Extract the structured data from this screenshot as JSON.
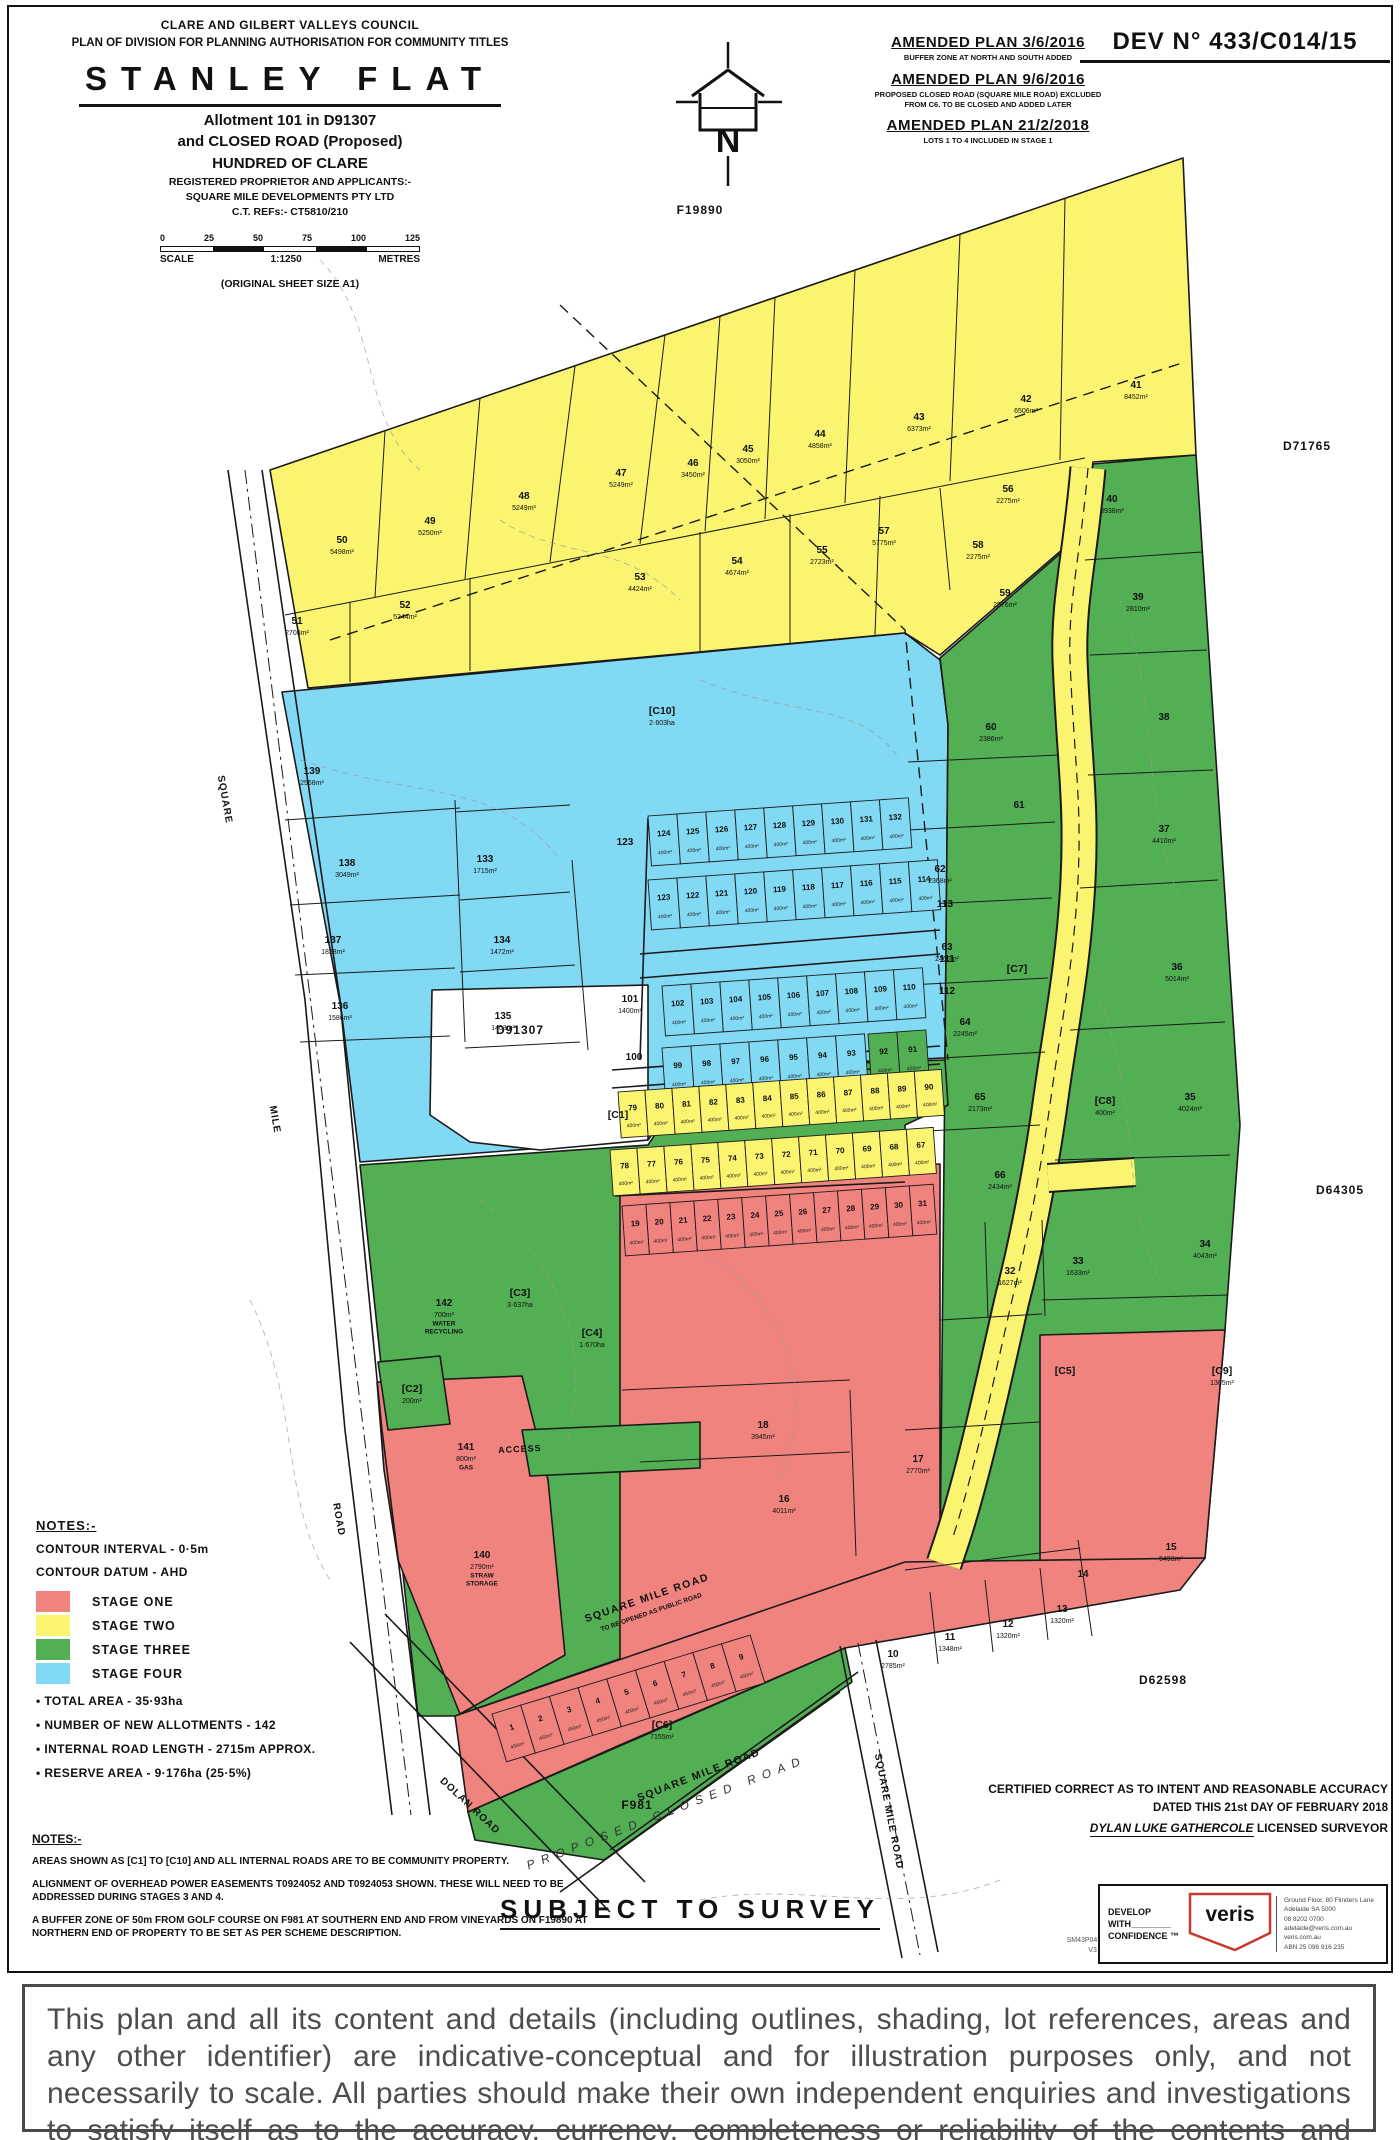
{
  "title_block": {
    "council": "CLARE AND GILBERT VALLEYS COUNCIL",
    "plan_type": "PLAN OF DIVISION FOR PLANNING AUTHORISATION FOR COMMUNITY TITLES",
    "title": "STANLEY FLAT",
    "allotment": "Allotment 101 in D91307",
    "closed_road": "and CLOSED ROAD (Proposed)",
    "hundred": "HUNDRED OF CLARE",
    "proprietor_label": "REGISTERED PROPRIETOR AND APPLICANTS:-",
    "proprietor": "SQUARE MILE DEVELOPMENTS PTY LTD",
    "ct_ref": "C.T. REFs:- CT5810/210",
    "scale_numbers": [
      "0",
      "25",
      "50",
      "75",
      "100",
      "125"
    ],
    "scale_label": "SCALE",
    "scale_ratio": "1:1250",
    "scale_units": "METRES",
    "sheet_size": "(ORIGINAL SHEET SIZE A1)"
  },
  "dev_no": "DEV N° 433/C014/15",
  "amendments": [
    {
      "title": "AMENDED PLAN 3/6/2016",
      "note": "BUFFER ZONE AT NORTH AND SOUTH ADDED"
    },
    {
      "title": "AMENDED PLAN 9/6/2016",
      "note": "PROPOSED CLOSED ROAD (SQUARE MILE ROAD) EXCLUDED",
      "note2": "FROM C6. TO BE CLOSED AND ADDED LATER"
    },
    {
      "title": "AMENDED PLAN 21/2/2018",
      "note": "LOTS 1 TO 4 INCLUDED IN STAGE 1"
    }
  ],
  "legend": {
    "head": "NOTES:-",
    "contour_interval": "CONTOUR INTERVAL - 0·5m",
    "contour_datum": "CONTOUR DATUM - AHD",
    "stages": [
      {
        "label": "STAGE ONE",
        "color": "#F1837F"
      },
      {
        "label": "STAGE TWO",
        "color": "#FAF470"
      },
      {
        "label": "STAGE THREE",
        "color": "#53AF53"
      },
      {
        "label": "STAGE FOUR",
        "color": "#82D9F4"
      }
    ],
    "bullets": [
      "TOTAL AREA - 35·93ha",
      "NUMBER OF NEW ALLOTMENTS - 142",
      "INTERNAL ROAD LENGTH - 2715m APPROX.",
      "RESERVE AREA - 9·176ha (25·5%)"
    ]
  },
  "notes2": {
    "head": "NOTES:-",
    "p1": "AREAS SHOWN AS [C1] TO [C10] AND ALL INTERNAL ROADS ARE TO BE COMMUNITY PROPERTY.",
    "p2": "ALIGNMENT OF OVERHEAD POWER EASEMENTS T0924052 AND T0924053 SHOWN. THESE WILL NEED TO BE ADDRESSED DURING STAGES 3 AND 4.",
    "p3": "A BUFFER ZONE OF 50m FROM GOLF COURSE ON F981 AT SOUTHERN END AND FROM VINEYARDS ON F19890 AT NORTHERN END OF PROPERTY TO BE SET AS PER SCHEME DESCRIPTION."
  },
  "certification": {
    "l1": "CERTIFIED CORRECT AS TO INTENT AND REASONABLE ACCURACY",
    "l2": "DATED THIS 21st DAY OF FEBRUARY 2018",
    "surveyor": "DYLAN LUKE GATHERCOLE",
    "surveyor_title": " LICENSED SURVEYOR"
  },
  "subject_to_survey": "SUBJECT TO SURVEY",
  "footer": {
    "file_ref_1": "SM43P04-v15.DWG",
    "file_ref_2": "V3  21/2/2018",
    "develop_1": "DEVELOP",
    "develop_2": "WITH________",
    "develop_3": "CONFIDENCE ™",
    "veris": "veris",
    "veris_color": "#C43A2E",
    "address_lines": [
      "Ground Floor, 80 Flinders Lane",
      "Adelaide SA 5000",
      "08 8202 0700",
      "adelaide@veris.com.au",
      "veris.com.au",
      "ABN 25 098 916 235"
    ]
  },
  "disclaimer": "This plan and all its content and details (including outlines, shading, lot references, areas and any other identifier) are indicative-conceptual and for illustration purposes only, and not necessarily to scale. All parties should make their own independent enquiries and investigations to satisfy itself as to the accuracy, currency, completeness or reliability of the contents and details contained in this plan",
  "map": {
    "colors": {
      "stage_one": "#F1837F",
      "stage_two": "#FAF470",
      "stage_three": "#53AF53",
      "stage_four": "#82D9F4",
      "line": "#1a1a1a"
    },
    "north_label": "N",
    "adjacent_labels": [
      {
        "t": "F19890",
        "x": 700,
        "y": 214
      },
      {
        "t": "D71765",
        "x": 1307,
        "y": 450
      },
      {
        "t": "D64305",
        "x": 1340,
        "y": 1194
      },
      {
        "t": "D62598",
        "x": 1163,
        "y": 1684
      },
      {
        "t": "D91307",
        "x": 520,
        "y": 1034
      },
      {
        "t": "F981",
        "x": 637,
        "y": 1809
      }
    ],
    "road_labels": [
      {
        "t": "SQUARE",
        "x": 222,
        "y": 800,
        "r": 80,
        "s": "rl"
      },
      {
        "t": "MILE",
        "x": 272,
        "y": 1120,
        "r": 80,
        "s": "rl"
      },
      {
        "t": "ROAD",
        "x": 336,
        "y": 1520,
        "r": 80,
        "s": "rl"
      },
      {
        "t": "DOLAN ROAD",
        "x": 468,
        "y": 1808,
        "r": 43,
        "s": "rl"
      },
      {
        "t": "SQUARE MILE ROAD",
        "x": 648,
        "y": 1601,
        "r": -19,
        "s": "rl-bold"
      },
      {
        "t": "TO BE OPENED AS PUBLIC ROAD",
        "x": 652,
        "y": 1614,
        "r": -19,
        "s": "rl-tiny"
      },
      {
        "t": "SQUARE MILE ROAD",
        "x": 700,
        "y": 1778,
        "r": -21,
        "s": "rl-bold"
      },
      {
        "t": "PROPOSED  CLOSED  ROAD",
        "x": 668,
        "y": 1816,
        "r": -21,
        "s": "rl-spread"
      },
      {
        "t": "SQUARE MILE ROAD",
        "x": 886,
        "y": 1812,
        "r": 79,
        "s": "rl"
      },
      {
        "t": "ACCESS",
        "x": 520,
        "y": 1452,
        "r": -3,
        "s": "rl-small"
      }
    ],
    "lots": [
      {
        "n": "41",
        "a": "8452m²",
        "x": 1136,
        "y": 388
      },
      {
        "n": "42",
        "a": "6506m²",
        "x": 1026,
        "y": 402
      },
      {
        "n": "43",
        "a": "6373m²",
        "x": 919,
        "y": 420
      },
      {
        "n": "44",
        "a": "4858m²",
        "x": 820,
        "y": 437
      },
      {
        "n": "45",
        "a": "3050m²",
        "x": 748,
        "y": 452
      },
      {
        "n": "46",
        "a": "3450m²",
        "x": 693,
        "y": 466
      },
      {
        "n": "47",
        "a": "5249m²",
        "x": 621,
        "y": 476
      },
      {
        "n": "48",
        "a": "5249m²",
        "x": 524,
        "y": 499
      },
      {
        "n": "49",
        "a": "5250m²",
        "x": 430,
        "y": 524
      },
      {
        "n": "50",
        "a": "5498m²",
        "x": 342,
        "y": 543
      },
      {
        "n": "51",
        "a": "2708m²",
        "x": 297,
        "y": 624
      },
      {
        "n": "52",
        "a": "5244m²",
        "x": 405,
        "y": 608
      },
      {
        "n": "53",
        "a": "4424m²",
        "x": 640,
        "y": 580
      },
      {
        "n": "54",
        "a": "4674m²",
        "x": 737,
        "y": 564
      },
      {
        "n": "55",
        "a": "2723m²",
        "x": 822,
        "y": 553
      },
      {
        "n": "57",
        "a": "5775m²",
        "x": 884,
        "y": 534
      },
      {
        "n": "56",
        "a": "2275m²",
        "x": 1008,
        "y": 492
      },
      {
        "n": "58",
        "a": "2275m²",
        "x": 978,
        "y": 548
      },
      {
        "n": "59",
        "a": "2576m²",
        "x": 1005,
        "y": 596
      },
      {
        "n": "60",
        "a": "2386m²",
        "x": 991,
        "y": 730
      },
      {
        "n": "61",
        "x": 1019,
        "y": 808
      },
      {
        "n": "62",
        "a": "2368m²",
        "x": 940,
        "y": 872
      },
      {
        "n": "63",
        "a": "2465m²",
        "x": 947,
        "y": 950
      },
      {
        "n": "64",
        "a": "2245m²",
        "x": 965,
        "y": 1025
      },
      {
        "n": "65",
        "a": "2173m²",
        "x": 980,
        "y": 1100
      },
      {
        "n": "66",
        "a": "2434m²",
        "x": 1000,
        "y": 1178
      },
      {
        "n": "40",
        "a": "3938m²",
        "x": 1112,
        "y": 502
      },
      {
        "n": "39",
        "a": "2810m²",
        "x": 1138,
        "y": 600
      },
      {
        "n": "38",
        "x": 1164,
        "y": 720
      },
      {
        "n": "37",
        "a": "4410m²",
        "x": 1164,
        "y": 832
      },
      {
        "n": "36",
        "a": "5014m²",
        "x": 1177,
        "y": 970
      },
      {
        "n": "35",
        "a": "4024m²",
        "x": 1190,
        "y": 1100
      },
      {
        "n": "34",
        "a": "4043m²",
        "x": 1205,
        "y": 1247
      },
      {
        "n": "[C10]",
        "a": "2·603ha",
        "x": 662,
        "y": 714,
        "c": 1
      },
      {
        "n": "139",
        "a": "2568m²",
        "x": 312,
        "y": 774
      },
      {
        "n": "138",
        "a": "3049m²",
        "x": 347,
        "y": 866
      },
      {
        "n": "137",
        "a": "1828m²",
        "x": 333,
        "y": 943
      },
      {
        "n": "136",
        "a": "1586m²",
        "x": 340,
        "y": 1009
      },
      {
        "n": "133",
        "a": "1715m²",
        "x": 485,
        "y": 862
      },
      {
        "n": "134",
        "a": "1472m²",
        "x": 502,
        "y": 943
      },
      {
        "n": "135",
        "a": "1403m²",
        "x": 503,
        "y": 1019
      },
      {
        "n": "123",
        "x": 625,
        "y": 845
      },
      {
        "n": "113",
        "x": 945,
        "y": 907
      },
      {
        "n": "111",
        "x": 947,
        "y": 962
      },
      {
        "n": "112",
        "x": 947,
        "y": 994
      },
      {
        "n": "101",
        "a": "1400m²",
        "x": 630,
        "y": 1002
      },
      {
        "n": "100",
        "x": 634,
        "y": 1060
      },
      {
        "n": "[C1]",
        "x": 618,
        "y": 1118,
        "c": 1
      },
      {
        "n": "32",
        "a": "1627m²",
        "x": 1010,
        "y": 1274
      },
      {
        "n": "33",
        "a": "1633m²",
        "x": 1078,
        "y": 1264
      },
      {
        "n": "[C4]",
        "a": "1·670ha",
        "x": 592,
        "y": 1336,
        "c": 1
      },
      {
        "n": "18",
        "a": "3945m²",
        "x": 763,
        "y": 1428
      },
      {
        "n": "16",
        "a": "4011m²",
        "x": 784,
        "y": 1502
      },
      {
        "n": "17",
        "a": "2770m²",
        "x": 918,
        "y": 1462
      },
      {
        "n": "[C5]",
        "x": 1065,
        "y": 1374,
        "c": 1
      },
      {
        "n": "[C9]",
        "a": "1305m²",
        "x": 1222,
        "y": 1374,
        "c": 1
      },
      {
        "n": "[C7]",
        "x": 1017,
        "y": 972,
        "c": 1
      },
      {
        "n": "[C8]",
        "a": "400m²",
        "x": 1105,
        "y": 1104,
        "c": 1
      },
      {
        "n": "15",
        "a": "5493m²",
        "x": 1171,
        "y": 1550
      },
      {
        "n": "14",
        "x": 1083,
        "y": 1577
      },
      {
        "n": "10",
        "a": "2785m²",
        "x": 893,
        "y": 1657
      },
      {
        "n": "11",
        "a": "1348m²",
        "x": 950,
        "y": 1640
      },
      {
        "n": "12",
        "a": "1320m²",
        "x": 1008,
        "y": 1627
      },
      {
        "n": "13",
        "a": "1320m²",
        "x": 1062,
        "y": 1612
      },
      {
        "n": "[C6]",
        "a": "7155m²",
        "x": 662,
        "y": 1728,
        "c": 1
      },
      {
        "n": "[C3]",
        "a": "3·637ha",
        "x": 520,
        "y": 1296,
        "c": 1
      },
      {
        "n": "142",
        "a": "700m²",
        "x": 444,
        "y": 1306,
        "sub": [
          "WATER",
          "RECYCLING"
        ]
      },
      {
        "n": "[C2]",
        "a": "200m²",
        "x": 412,
        "y": 1392,
        "c": 1
      },
      {
        "n": "141",
        "a": "800m²",
        "x": 466,
        "y": 1450,
        "sub": [
          "GAS"
        ]
      },
      {
        "n": "140",
        "a": "2790m²",
        "x": 482,
        "y": 1558,
        "sub": [
          "STRAW",
          "STORAGE"
        ]
      }
    ],
    "grid_area_note": "typical small lot area",
    "grid_rows": [
      {
        "x": 648,
        "y": 816,
        "cw": 29,
        "ch": 50,
        "r": -4,
        "fill": "stage_four",
        "cell_area": "400m²",
        "labels": [
          "124",
          "125",
          "126",
          "127",
          "128",
          "129",
          "130",
          "131",
          "132"
        ]
      },
      {
        "x": 648,
        "y": 880,
        "cw": 29,
        "ch": 50,
        "r": -4,
        "fill": "stage_four",
        "cell_area": "400m²",
        "labels": [
          "123",
          "122",
          "121",
          "120",
          "119",
          "118",
          "117",
          "116",
          "115",
          "114"
        ]
      },
      {
        "x": 662,
        "y": 986,
        "cw": 29,
        "ch": 50,
        "r": -4,
        "fill": "stage_four",
        "cell_area": "400m²",
        "labels": [
          "102",
          "103",
          "104",
          "105",
          "106",
          "107",
          "108",
          "109",
          "110"
        ]
      },
      {
        "x": 662,
        "y": 1048,
        "cw": 29,
        "ch": 50,
        "r": -4,
        "fill": "stage_four",
        "cell_area": "400m²",
        "labels": [
          "99",
          "98",
          "97",
          "96",
          "95",
          "94",
          "93"
        ]
      },
      {
        "x": 868,
        "y": 1034,
        "cw": 29,
        "ch": 50,
        "r": -4,
        "fill": "stage_three",
        "cell_area": "400m²",
        "labels": [
          "92",
          "91"
        ]
      },
      {
        "x": 618,
        "y": 1092,
        "cw": 27,
        "ch": 46,
        "r": -4,
        "fill": "stage_two",
        "cell_area": "400m²",
        "labels": [
          "79",
          "80",
          "81",
          "82",
          "83",
          "84",
          "85",
          "86",
          "87",
          "88",
          "89",
          "90"
        ]
      },
      {
        "x": 610,
        "y": 1150,
        "cw": 27,
        "ch": 46,
        "r": -4,
        "fill": "stage_two",
        "cell_area": "400m²",
        "labels": [
          "78",
          "77",
          "76",
          "75",
          "74",
          "73",
          "72",
          "71",
          "70",
          "69",
          "68",
          "67"
        ]
      },
      {
        "x": 622,
        "y": 1206,
        "cw": 24,
        "ch": 50,
        "r": -4,
        "fill": "stage_one",
        "cell_area": "400m²",
        "labels": [
          "19",
          "20",
          "21",
          "22",
          "23",
          "24",
          "25",
          "26",
          "27",
          "28",
          "29",
          "30",
          "31"
        ]
      },
      {
        "x": 492,
        "y": 1714,
        "cw": 30,
        "ch": 50,
        "r": -17,
        "fill": "stage_one",
        "cell_area": "450m²",
        "labels": [
          "1",
          "2",
          "3",
          "4",
          "5",
          "6",
          "7",
          "8",
          "9"
        ]
      }
    ]
  }
}
